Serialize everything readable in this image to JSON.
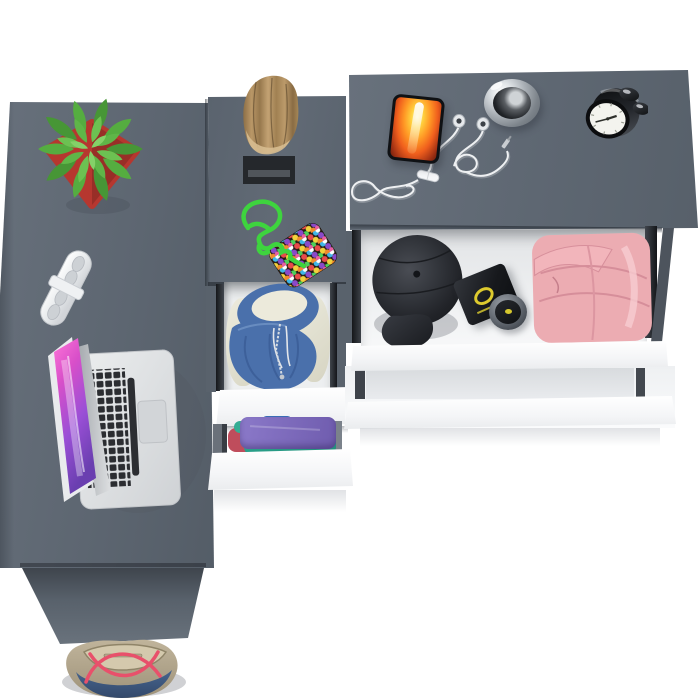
{
  "scene": {
    "type": "product-render",
    "view": "overhead top-down",
    "description": "Gray L-shaped corner desk with a middle drawer cabinet and a right dresser; drawers pulled open showing folded clothes and accessories; lifestyle props on the desktop",
    "background": "#ffffff"
  },
  "palette": {
    "desk_gray": "#5d6671",
    "desk_gray_dark": "#4a525b",
    "drawer_front_white": "#fafbfc",
    "drawer_interior": "#edeff0",
    "rail_dark": "#22262b",
    "pot_red": "#b6372f",
    "plant_green": "#55ad40",
    "wood_tan": "#b5955f",
    "stand_black": "#25282c",
    "paracord_green": "#3ed43e",
    "hoodie_blue": "#4a70ab",
    "hoodie_lining_cream": "#eceadb",
    "folded_purple": "#8472c2",
    "folded_teal": "#2aa08a",
    "folded_red": "#bf4d5c",
    "folded_blue": "#3a6cb5",
    "cap_black": "#2e3036",
    "box_black": "#17191c",
    "logo_yellow": "#ddca2e",
    "pants_pink": "#ecacb2",
    "laptop_silver": "#d7d9db",
    "laptop_screen_pink": "#d84fc9",
    "key_black": "#2b2d31",
    "phone_fire_orange": "#ff9825",
    "cable_white": "#eef0f2",
    "chrome": "#c7ccd1",
    "clock_black": "#17181a",
    "clock_face": "#f3f3ee",
    "bag_denim": "#44618a",
    "bag_beige": "#b3a78f",
    "bag_strap_red": "#e8506b"
  },
  "furniture": {
    "left_desk": {
      "label": "gray desk surface with front panel",
      "surface_items": [
        {
          "label": "succulent plant in red square pot"
        },
        {
          "label": "white two-piece furniture lock"
        },
        {
          "label": "open silver laptop with pink-purple wallpaper"
        }
      ],
      "floor_item": {
        "label": "denim and beige tote bag with red straps"
      }
    },
    "middle_cabinet": {
      "label": "drawer cabinet between desk and dresser",
      "surface_items": [
        {
          "label": "wooden log decor on black stand"
        },
        {
          "label": "green paracord pouch covered in candy dots"
        }
      ],
      "drawers": [
        {
          "state": "open",
          "front": "white",
          "contents": [
            "blue hoodie",
            "cream garments"
          ]
        },
        {
          "state": "open",
          "front": "white",
          "contents": [
            "purple folded shirt",
            "teal folded shirt",
            "red folded shirt",
            "blue folded shirt"
          ]
        }
      ]
    },
    "right_dresser": {
      "label": "dresser with pulled-out top drawer",
      "surface_items": [
        {
          "label": "smartphone showing flame wallpaper"
        },
        {
          "label": "white earphones with tangled cable and inline remote"
        },
        {
          "label": "chrome pocket-watch style disc"
        },
        {
          "label": "black twin-bell alarm clock"
        }
      ],
      "drawers": [
        {
          "state": "open",
          "front": "white",
          "contents": [
            "black cap",
            "black box with yellow logo",
            "round cologne bottle",
            "pink folded sweatpants"
          ]
        },
        {
          "state": "closed",
          "front": "white",
          "contents": []
        }
      ]
    }
  }
}
